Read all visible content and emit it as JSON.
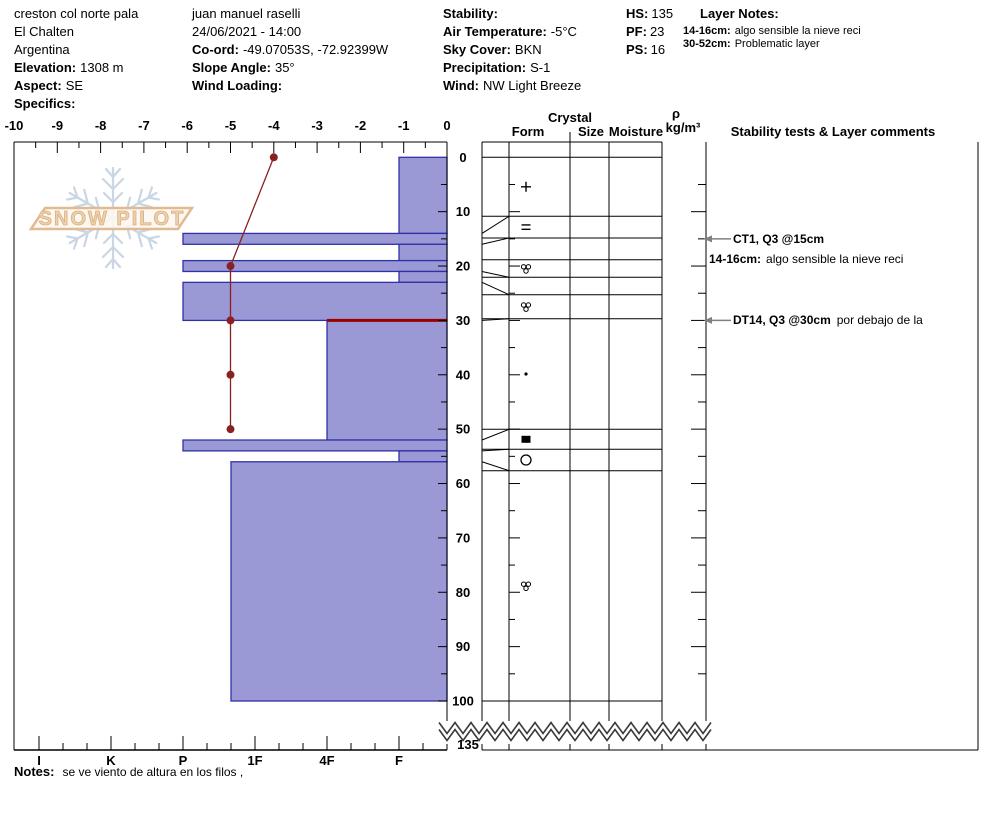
{
  "info_left": {
    "site": "creston col norte pala",
    "town": "El Chalten",
    "country": "Argentina",
    "elevation_label": "Elevation:",
    "elevation_value": "1308 m",
    "aspect_label": "Aspect:",
    "aspect_value": "SE",
    "specifics_label": "Specifics:"
  },
  "info_mid": {
    "observer": "juan manuel raselli",
    "datetime": "24/06/2021 - 14:00",
    "coord_label": "Co-ord:",
    "coord_value": "-49.07053S, -72.92399W",
    "slope_label": "Slope Angle:",
    "slope_value": "35°",
    "windloading_label": "Wind Loading:",
    "windloading_value": ""
  },
  "info_weather": {
    "stability_label": "Stability:",
    "stability_value": "",
    "airtemp_label": "Air Temperature:",
    "airtemp_value": "-5°C",
    "sky_label": "Sky Cover:",
    "sky_value": "BKN",
    "precip_label": "Precipitation:",
    "precip_value": "S-1",
    "wind_label": "Wind:",
    "wind_value": "NW Light Breeze"
  },
  "info_hs": {
    "hs_label": "HS:",
    "hs_value": "135",
    "pf_label": "PF:",
    "pf_value": "23",
    "ps_label": "PS:",
    "ps_value": "16"
  },
  "layer_notes": {
    "title": "Layer Notes:",
    "items": [
      {
        "range": "14-16cm:",
        "text": "algo sensible la nieve reci"
      },
      {
        "range": "30-52cm:",
        "text": "Problematic layer"
      }
    ]
  },
  "columns": {
    "crystal": "Crystal",
    "form": "Form",
    "size": "Size",
    "moisture": "Moisture",
    "rho": "ρ",
    "rho_units": "kg/m³",
    "stability": "Stability tests & Layer comments"
  },
  "stability_annotations": [
    {
      "arrow_depth": 15,
      "bold": "CT1, Q3 @15cm",
      "rest": ""
    },
    {
      "arrow_depth": null,
      "bold": "14-16cm:",
      "rest": "algo sensible la nieve reci"
    },
    {
      "arrow_depth": 30,
      "bold": "DT14, Q3 @30cm",
      "rest": "por debajo de la"
    }
  ],
  "notes": {
    "label": "Notes:",
    "text": "se ve viento de altura en los filos ,"
  },
  "watermark": {
    "text": "SNOW PILOT"
  },
  "chart_data": {
    "type": "snow-profile",
    "title": "Snow pit hardness profile with temperature trace",
    "depth_axis": {
      "label_ticks": [
        0,
        10,
        20,
        30,
        40,
        50,
        60,
        70,
        80,
        90,
        100
      ],
      "minor_step": 5,
      "pit_depth": 100,
      "total_snow_height": "135",
      "units": "cm"
    },
    "temp_axis": {
      "ticks": [
        -10,
        -9,
        -8,
        -7,
        -6,
        -5,
        -4,
        -3,
        -2,
        -1,
        0
      ],
      "units": "°C"
    },
    "hardness_axis": {
      "labels": [
        "I",
        "K",
        "P",
        "1F",
        "4F",
        "F"
      ]
    },
    "layers": [
      {
        "top": 0,
        "bottom": 14,
        "hardness": "F"
      },
      {
        "top": 14,
        "bottom": 16,
        "hardness": "P"
      },
      {
        "top": 16,
        "bottom": 19,
        "hardness": "F"
      },
      {
        "top": 19,
        "bottom": 21,
        "hardness": "P"
      },
      {
        "top": 21,
        "bottom": 23,
        "hardness": "F"
      },
      {
        "top": 23,
        "bottom": 30,
        "hardness": "P"
      },
      {
        "top": 30,
        "bottom": 52,
        "hardness": "4F",
        "flag": "problem"
      },
      {
        "top": 52,
        "bottom": 54,
        "hardness": "P"
      },
      {
        "top": 54,
        "bottom": 56,
        "hardness": "F"
      },
      {
        "top": 56,
        "bottom": 100,
        "hardness": "1F+"
      }
    ],
    "temperature_profile": [
      {
        "depth": 0,
        "temp": -4
      },
      {
        "depth": 20,
        "temp": -5
      },
      {
        "depth": 30,
        "temp": -5
      },
      {
        "depth": 40,
        "temp": -5
      },
      {
        "depth": 50,
        "temp": -5
      }
    ],
    "grain_symbols": [
      {
        "layer_index": 0,
        "symbol": "plus"
      },
      {
        "layer_index": 1,
        "symbol": "equals"
      },
      {
        "layer_index": 3,
        "symbol": "cluster"
      },
      {
        "layer_index": 5,
        "symbol": "cluster"
      },
      {
        "layer_index": 6,
        "symbol": "dot"
      },
      {
        "layer_index": 7,
        "symbol": "square-filled"
      },
      {
        "layer_index": 8,
        "symbol": "circle-open"
      },
      {
        "layer_index": 9,
        "symbol": "cluster"
      }
    ],
    "colors": {
      "bar_fill": "#9a99d6",
      "bar_border": "#3030a8",
      "temp_line": "#8b2020",
      "problem_line": "#990000",
      "watermark_flake": "#c9d6e4",
      "watermark_tan": "#e3c29e"
    }
  }
}
